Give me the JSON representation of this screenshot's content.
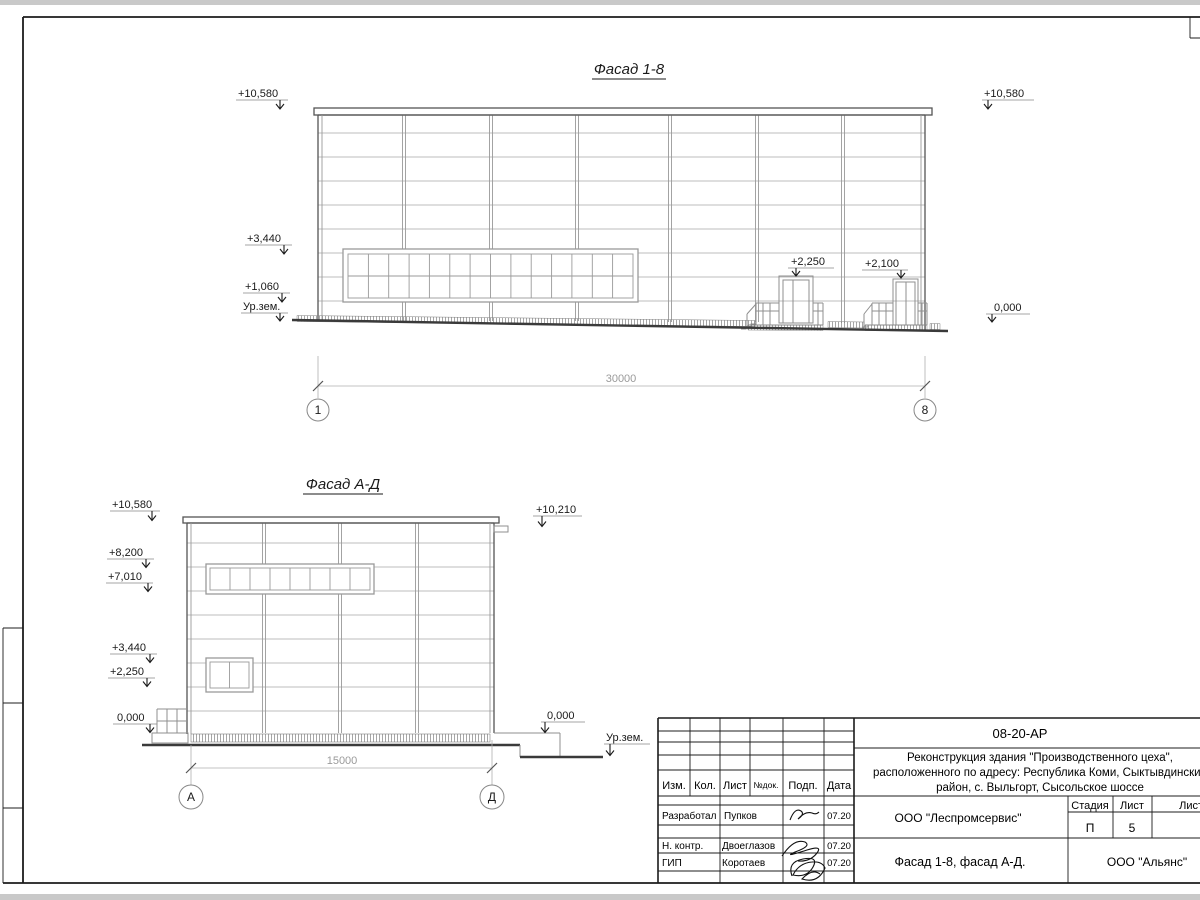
{
  "facade18": {
    "title": "Фасад 1-8",
    "lv_l_10580": "+10,580",
    "lv_l_3440": "+3,440",
    "lv_l_1060": "+1,060",
    "lv_l_ground": "Ур.зем.",
    "lv_r_10580": "+10,580",
    "lv_r_0": "0,000",
    "lv_door1": "+2,250",
    "lv_door2": "+2,100",
    "dim": "30000",
    "axis_left": "1",
    "axis_right": "8"
  },
  "facadeAD": {
    "title": "Фасад А-Д",
    "lv_10580": "+10,580",
    "lv_8200": "+8,200",
    "lv_7010": "+7,010",
    "lv_3440": "+3,440",
    "lv_2250": "+2,250",
    "lv_0_left": "0,000",
    "lv_10210": "+10,210",
    "lv_0_right": "0,000",
    "lv_ground": "Ур.зем.",
    "dim": "15000",
    "axis_left": "А",
    "axis_right": "Д"
  },
  "titleblock": {
    "doc_code": "08-20-АР",
    "desc1": "Реконструкция здания \"Производственного цеха\",",
    "desc2": "расположенного по адресу: Республика Коми, Сыктывдинский",
    "desc3": "район, с. Выльгорт, Сысольское шоссе",
    "col_izm": "Изм.",
    "col_kol": "Кол.",
    "col_list": "Лист",
    "col_ndok": "№док.",
    "col_podp": "Подп.",
    "col_data": "Дата",
    "r1_role": "Разработал",
    "r1_name": "Пупков",
    "r1_date": "07.20",
    "r2_role": "Н. контр.",
    "r2_name": "Двоеглазов",
    "r2_date": "07.20",
    "r3_role": "ГИП",
    "r3_name": "Коротаев",
    "r3_date": "07.20",
    "org1": "ООО \"Леспромсервис\"",
    "stage_label": "Стадия",
    "list_label": "Лист",
    "listov_label": "Листов",
    "stage_value": "П",
    "list_value": "5",
    "sheet_name": "Фасад 1-8, фасад А-Д.",
    "org2": "ООО \"Альянс\""
  }
}
